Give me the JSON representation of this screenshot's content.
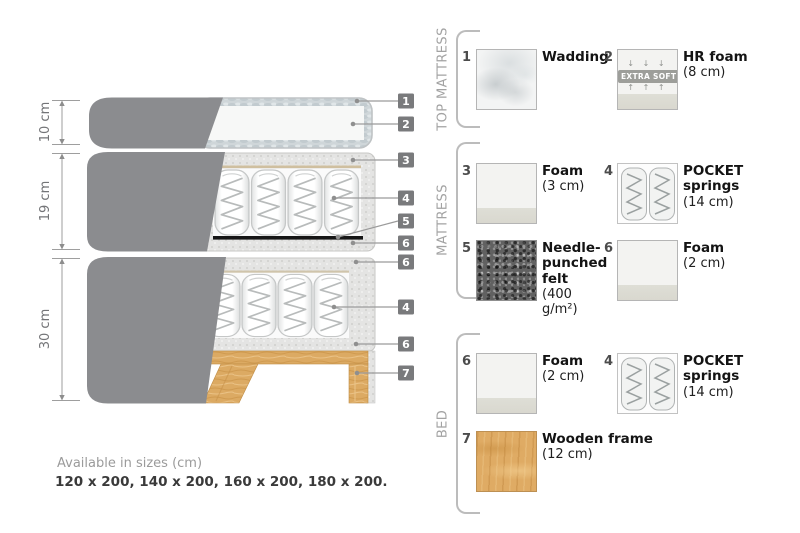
{
  "diagram": {
    "dimensions": [
      "10 cm",
      "19 cm",
      "30 cm"
    ],
    "callouts": [
      "1",
      "2",
      "3",
      "4",
      "5",
      "6",
      "6",
      "4",
      "6",
      "7"
    ]
  },
  "sections": [
    {
      "label": "TOP MATTRESS"
    },
    {
      "label": "MATTRESS"
    },
    {
      "label": "BED"
    }
  ],
  "legend": {
    "items": [
      {
        "number": "1",
        "name": "Wadding",
        "size": ""
      },
      {
        "number": "2",
        "name": "HR foam",
        "size": "(8 cm)"
      },
      {
        "number": "3",
        "name": "Foam",
        "size": "(3 cm)"
      },
      {
        "number": "4",
        "name": "POCKET springs",
        "size": "(14 cm)"
      },
      {
        "number": "5",
        "name": "Needle-punched felt",
        "size": "(400 g/m²)"
      },
      {
        "number": "6",
        "name": "Foam",
        "size": "(2 cm)"
      },
      {
        "number": "6",
        "name": "Foam",
        "size": "(2 cm)"
      },
      {
        "number": "4",
        "name": "POCKET springs",
        "size": "(14 cm)"
      },
      {
        "number": "7",
        "name": "Wooden frame",
        "size": "(12 cm)"
      }
    ],
    "extra_soft_badge": {
      "label": "EXTRA SOFT",
      "arrows_down": "↓ ↓ ↓",
      "arrows_up": "↑ ↑ ↑"
    }
  },
  "footer": {
    "note": "Available in sizes (cm)",
    "sizes": "120 x 200, 140 x 200, 160 x 200, 180 x 200."
  },
  "colors": {
    "fabric_gray": "#8b8c8f",
    "quilt_gray": "#e3e3e2",
    "wadding_band": "#ccd3d6",
    "wood_tan": "#dcaa63",
    "felt_dark": "#616161",
    "callout_badge_bg": "#797a7c"
  }
}
